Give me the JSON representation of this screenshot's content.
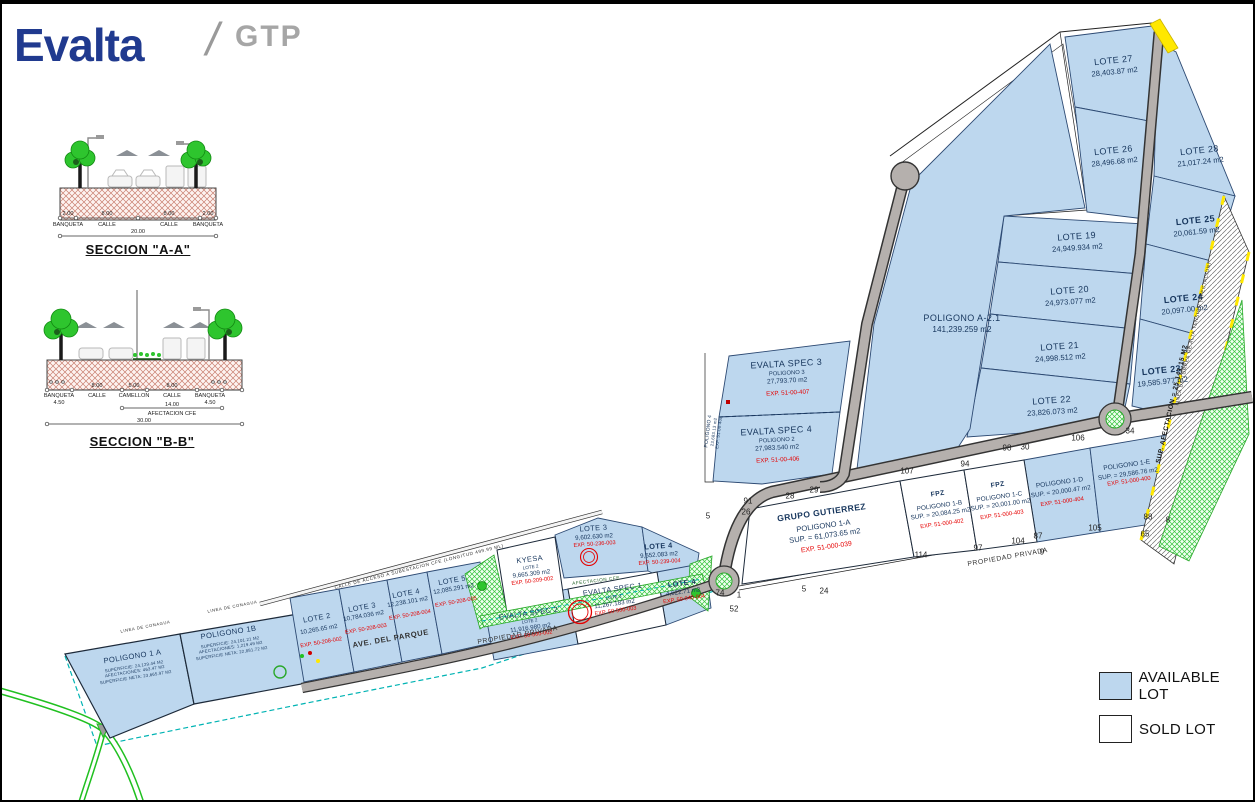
{
  "header": {
    "brand": "Evalta",
    "slash": "/",
    "suffix": "GTP"
  },
  "colors": {
    "brand": "#203a8f",
    "navy": "#17365d",
    "red": "#e60000",
    "available": "#bdd7ee",
    "sold": "#ffffff",
    "road": "#b5b0ad",
    "green": "#2fd22f",
    "teal": "#00b3b3",
    "yellow": "#ffe800",
    "gray": "#a6a6a6"
  },
  "sections": {
    "a": {
      "title": "SECCION \"A-A\"",
      "dims": [
        "2.00",
        "8.00",
        "8.00",
        "2.00"
      ],
      "labels": [
        "BANQUETA",
        "CALLE",
        "CALLE",
        "BANQUETA"
      ],
      "total": "20.00"
    },
    "b": {
      "title": "SECCION \"B-B\"",
      "dims": [
        "8.00",
        "5.00",
        "8.00"
      ],
      "labels": [
        "BANQUETA",
        "CALLE",
        "CAMELLON",
        "CALLE",
        "BANQUETA"
      ],
      "banqueta_width": "4.50",
      "afectacion_dim": "14.00",
      "afectacion_label": "AFECTACION CFE",
      "total": "30.00"
    }
  },
  "lots": {
    "lote27": {
      "name": "LOTE 27",
      "area": "28,403.87 m2"
    },
    "lote26": {
      "name": "LOTE 26",
      "area": "28,496.68 m2"
    },
    "lote28": {
      "name": "LOTE 28",
      "area": "21,017.24 m2"
    },
    "lote25": {
      "name": "LOTE 25",
      "area": "20,061.59 m2"
    },
    "lote24": {
      "name": "LOTE 24",
      "area": "20,097.00 m2"
    },
    "lote23": {
      "name": "LOTE 23",
      "area": "19,585.977 m2"
    },
    "lote19": {
      "name": "LOTE 19",
      "area": "24,949.934 m2"
    },
    "lote20": {
      "name": "LOTE 20",
      "area": "24,973.077 m2"
    },
    "lote21": {
      "name": "LOTE 21",
      "area": "24,998.512 m2"
    },
    "lote22": {
      "name": "LOTE 22",
      "area": "23,826.073 m2"
    },
    "pol_a21": {
      "name": "POLIGONO A-2.1",
      "area": "141,239.259 m2"
    },
    "spec3": {
      "name": "EVALTA SPEC 3",
      "sub": "POLIGONO 3",
      "area": "27,793.70 m2",
      "exp": "EXP. 51-00-407"
    },
    "spec4": {
      "name": "EVALTA SPEC 4",
      "sub": "POLIGONO 2",
      "area": "27,983.540 m2",
      "exp": "EXP. 51-00-406"
    },
    "pol4": {
      "name": "POLIGONO 4",
      "area": "23,683.13 m2",
      "exp": "EXP. 51-00-408"
    },
    "gutierrez": {
      "name": "GRUPO GUTIERREZ",
      "sub": "POLIGONO 1-A",
      "area": "SUP. = 61,073.65 m2",
      "exp": "EXP. 51-000-039"
    },
    "fpz1b": {
      "name": "FPZ",
      "sub": "POLIGONO 1-B",
      "area": "SUP. = 20,084.25 m2",
      "exp": "EXP. 51-000-402"
    },
    "fpz1c": {
      "name": "FPZ",
      "sub": "POLIGONO 1-C",
      "area": "SUP. = 20,001.00 m2",
      "exp": "EXP. 51-000-403"
    },
    "pol1d": {
      "name": "POLIGONO 1-D",
      "area": "SUP. = 20,000.47 m2",
      "exp": "EXP. 51-000-404"
    },
    "pol1e": {
      "name": "POLIGONO 1-E",
      "area": "SUP. = 29,586.76 m2",
      "exp": "EXP. 51-000-400"
    },
    "pol1a": {
      "name": "POLIGONO 1 A",
      "l1": "SUPERFICIE: 24,129.44 M2",
      "l2": "AFECTACIONES: 463.47 M2",
      "l3": "SUPERFICIE NETA: 23,665.97 M2"
    },
    "pol1b": {
      "name": "POLIGONO 1B",
      "l1": "SUPERFICIE: 24,101.21 M2",
      "l2": "AFECTACIONES: 1,219.49 M2",
      "l3": "SUPERFICIE NETA: 22,881.72 M2"
    },
    "lote2": {
      "name": "LOTE 2",
      "area": "10,265.65 m2",
      "exp": "EXP. 50-208-002"
    },
    "lote3": {
      "name": "LOTE 3",
      "area": "10,784.036 m2",
      "exp": "EXP. 50-208-003"
    },
    "lote4": {
      "name": "LOTE 4",
      "area": "12,238.101 m2",
      "exp": "EXP. 50-208-004"
    },
    "lote5": {
      "name": "LOTE 5",
      "area": "12,085.291 m2",
      "exp": "EXP. 50-208-005"
    },
    "kyesa": {
      "name": "KYESA",
      "sub": "LOTE 2",
      "area": "9,665.309 m2",
      "exp": "EXP. 50-209-002"
    },
    "lote3m": {
      "name": "LOTE 3",
      "area": "9,602.630 m2",
      "exp": "EXP. 50-236-003"
    },
    "lote4m": {
      "name": "LOTE 4",
      "area": "9,552.083 m2",
      "exp": "EXP. 50-239-004"
    },
    "spec2": {
      "name": "EVALTA SPEC 2",
      "sub": "LOTE 2",
      "area": "11,916.980 m2",
      "exp": "EXP. 50-500-002"
    },
    "spec1": {
      "name": "EVALTA SPEC 1",
      "sub": "LOTE 3",
      "area": "11,267.183 m2",
      "exp": "EXP. 50-500-003"
    },
    "lote4s": {
      "name": "LOTE 4",
      "area": "4,622.71 m2",
      "exp": "EXP. 50-040-004"
    }
  },
  "roads": {
    "ave_parque": "AVE. DEL PARQUE",
    "propiedad_privada_1": "PROPIEDAD PRIVADA",
    "propiedad_privada_2": "PROPIEDAD PRIVADA",
    "calle_acceso": "CALLE DE ACCESO A SUBESTACION CFE (LONGITUD 499.99 ML)",
    "linea_conagua_1": "LINEA DE CONAGUA",
    "linea_conagua_2": "LINEA DE CONAGUA",
    "linea_torres": "LINEA DE TORRES DE ALTA TENSION (AFECTACION)",
    "sup_afectacion": "SUP. AFECTACION = 25,141.15 M2",
    "afectacion_cfe": "AFECTACION CFE"
  },
  "boundary_numbers": [
    "91",
    "26",
    "5",
    "28",
    "29",
    "107",
    "94",
    "98",
    "30",
    "106",
    "34",
    "114",
    "97",
    "104",
    "87",
    "9",
    "105",
    "88",
    "8",
    "65",
    "74",
    "1",
    "5",
    "24",
    "52"
  ],
  "legend": {
    "available": "AVAILABLE LOT",
    "sold": "SOLD LOT"
  }
}
